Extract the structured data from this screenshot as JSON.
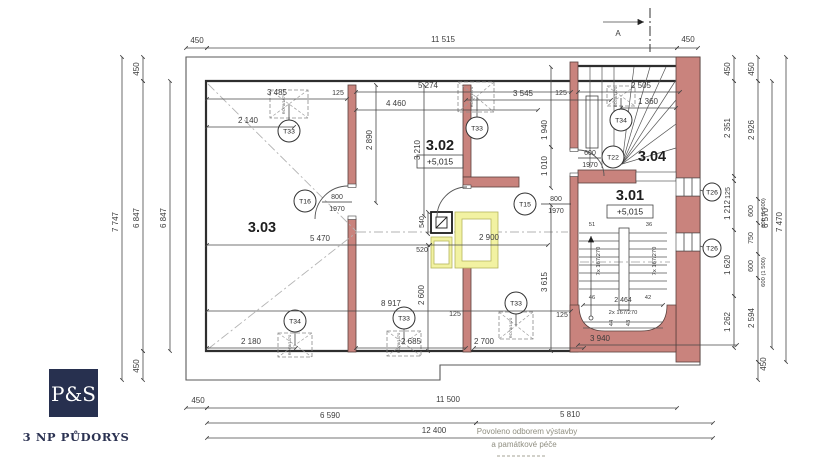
{
  "title_block": {
    "brand": "P&S",
    "drawing_title": "3 NP PŮDORYS"
  },
  "stamp": {
    "line1": "Povoleno odborem výstavby",
    "line2": "a památkové péče"
  },
  "section_marker": {
    "label": "A"
  },
  "rooms": {
    "r303": {
      "number": "3.03"
    },
    "r302": {
      "number": "3.02",
      "level": "+5,015"
    },
    "r301": {
      "number": "3.01",
      "level": "+5,015"
    },
    "r304": {
      "number": "3.04"
    }
  },
  "tags": {
    "t33": "T33",
    "t34": "T34",
    "t16": "T16",
    "t15": "T15",
    "t22": "T22",
    "t26": "T26"
  },
  "doors": {
    "w800": "800",
    "w600": "600",
    "h1970": "1970"
  },
  "roof_window_code": "RO78/1470",
  "stairs": {
    "run7": "7x 167/270",
    "run2": "2x 167/270",
    "width": "2 464",
    "n51": "51",
    "n36": "36",
    "n46": "46",
    "n42": "42",
    "n44": "44",
    "n43": "43"
  },
  "dims": {
    "top450l": "450",
    "top11515": "11 515",
    "top450r": "450",
    "l7747": "7 747",
    "l450t": "450",
    "l6847": "6 847",
    "l450b": "450",
    "l6847i": "6 847",
    "d3485": "3 485",
    "d125a": "125",
    "d2140": "2 140",
    "d4460": "4 460",
    "d5274": "5 274",
    "d3545": "3 545",
    "d125b": "125",
    "d2505": "2 505",
    "d1360": "1 360",
    "d2890": "2 890",
    "d3210": "3 210",
    "d1940": "1 940",
    "d1010": "1 010",
    "d3615": "3 615",
    "d5470": "5 470",
    "d2900": "2 900",
    "d540": "540",
    "d520": "520",
    "d2600": "2 600",
    "d8917": "8 917",
    "d2180": "2 180",
    "d2685": "2 685",
    "d125c": "125",
    "d125d": "125",
    "d2700": "2 700",
    "d3940": "3 940",
    "r450a": "450",
    "r2351": "2 351",
    "r125": "125",
    "r1212": "1 212",
    "r1620": "1 620",
    "r1262": "1 262",
    "r450b": "450",
    "r2926": "2 926",
    "r600a": "600",
    "r600p1": "600 (1 500)",
    "r750": "750",
    "r600b": "600",
    "r600p2": "600 (1 500)",
    "r2594": "2 594",
    "r450c": "450",
    "r6570": "6 570",
    "r7470": "7 470",
    "b450": "450",
    "b11500": "11 500",
    "b6590": "6 590",
    "b5810": "5 810",
    "b12400": "12 400"
  }
}
